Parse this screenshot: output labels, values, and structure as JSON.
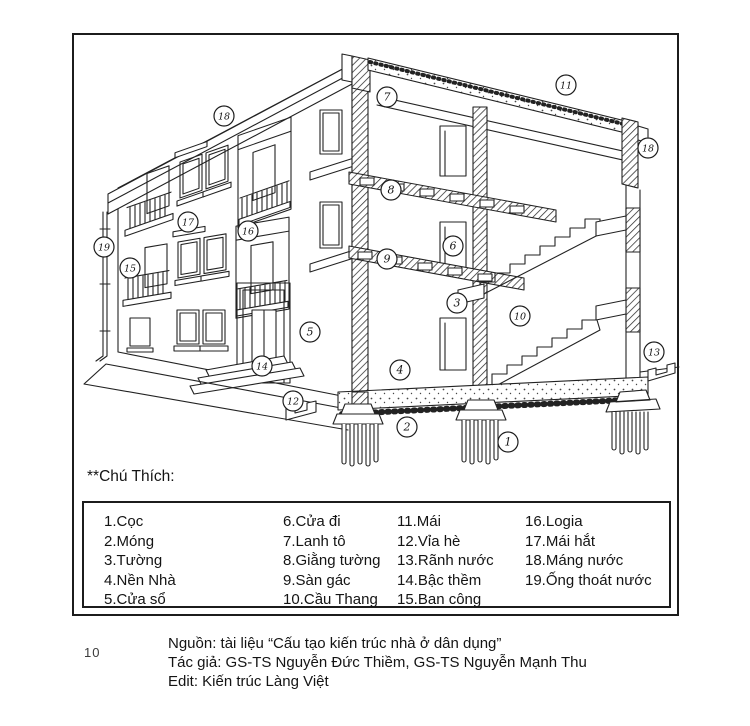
{
  "figure": {
    "legend_title": "**Chú Thích:",
    "legend_columns": [
      [
        {
          "num": "1.",
          "label": "Cọc"
        },
        {
          "num": "2.",
          "label": "Móng"
        },
        {
          "num": "3.",
          "label": "Tường"
        },
        {
          "num": "4.",
          "label": "Nền Nhà"
        },
        {
          "num": "5.",
          "label": "Cửa sổ"
        }
      ],
      [
        {
          "num": "6.",
          "label": "Cửa đi"
        },
        {
          "num": "7.",
          "label": "Lanh tô"
        },
        {
          "num": "8.",
          "label": "Giằng tường"
        },
        {
          "num": "9.",
          "label": "Sàn gác"
        },
        {
          "num": "10.",
          "label": "Cầu Thang"
        }
      ],
      [
        {
          "num": "11.",
          "label": "Mái"
        },
        {
          "num": "12.",
          "label": "Vỉa hè"
        },
        {
          "num": "13.",
          "label": "Rãnh nước"
        },
        {
          "num": "14.",
          "label": "Bậc thềm"
        },
        {
          "num": "15.",
          "label": "Ban công"
        }
      ],
      [
        {
          "num": "16.",
          "label": "Logia"
        },
        {
          "num": "17.",
          "label": "Mái hắt"
        },
        {
          "num": "18.",
          "label": "Máng nước"
        },
        {
          "num": "19.",
          "label": "Ống thoát nước"
        }
      ]
    ],
    "callouts": [
      {
        "n": "1",
        "x": 508,
        "y": 442
      },
      {
        "n": "2",
        "x": 407,
        "y": 427
      },
      {
        "n": "3",
        "x": 457,
        "y": 303
      },
      {
        "n": "4",
        "x": 400,
        "y": 370
      },
      {
        "n": "5",
        "x": 310,
        "y": 332
      },
      {
        "n": "6",
        "x": 453,
        "y": 246
      },
      {
        "n": "7",
        "x": 387,
        "y": 97
      },
      {
        "n": "8",
        "x": 391,
        "y": 190
      },
      {
        "n": "9",
        "x": 387,
        "y": 259
      },
      {
        "n": "10",
        "x": 520,
        "y": 316
      },
      {
        "n": "11",
        "x": 566,
        "y": 85
      },
      {
        "n": "12",
        "x": 293,
        "y": 401
      },
      {
        "n": "13",
        "x": 654,
        "y": 352
      },
      {
        "n": "14",
        "x": 262,
        "y": 366
      },
      {
        "n": "15",
        "x": 130,
        "y": 268
      },
      {
        "n": "16",
        "x": 248,
        "y": 231
      },
      {
        "n": "17",
        "x": 188,
        "y": 222
      },
      {
        "n": "18",
        "x": 224,
        "y": 116
      },
      {
        "n": "18",
        "x": 648,
        "y": 148
      },
      {
        "n": "19",
        "x": 104,
        "y": 247
      }
    ],
    "attribution": [
      "Nguồn: tài liệu “Cấu tạo kiến trúc nhà ở dân dụng”",
      "Tác giả: GS-TS Nguyễn Đức Thiềm, GS-TS Nguyễn Mạnh Thu",
      "Edit: Kiến trúc Làng Việt"
    ],
    "page_number": "10"
  }
}
